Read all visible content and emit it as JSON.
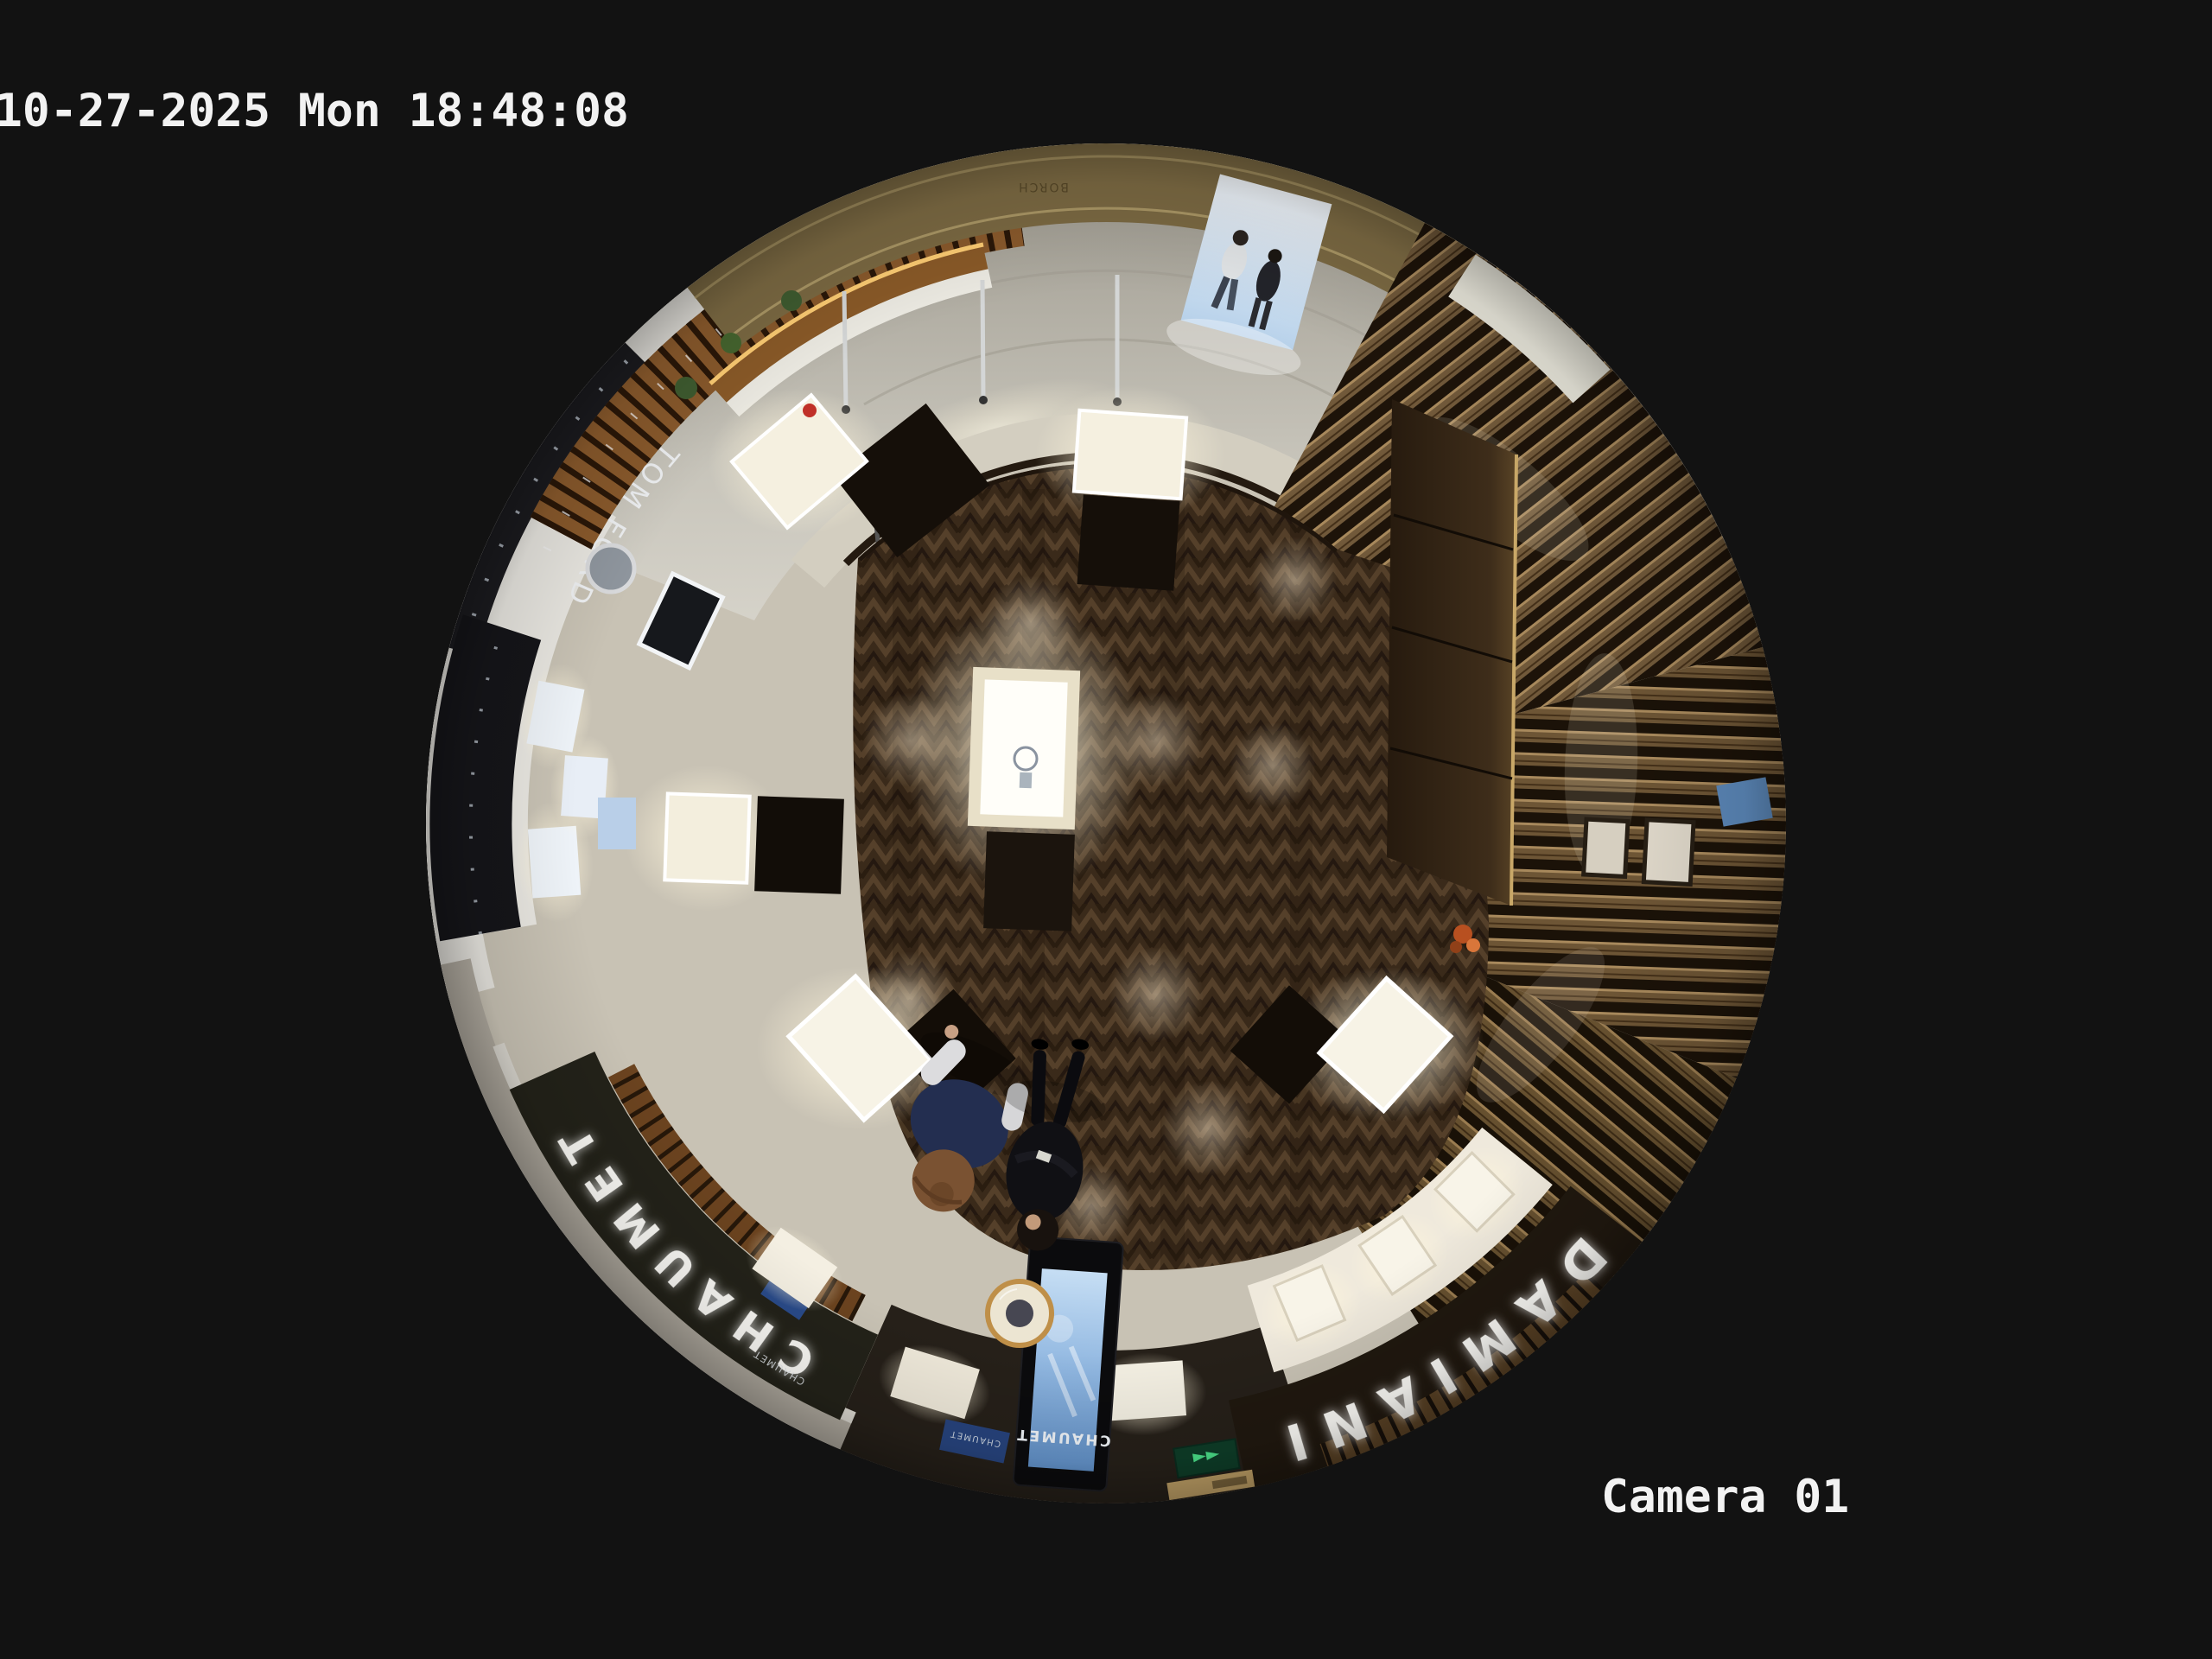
{
  "osd": {
    "timestamp": "10-27-2025 Mon 18:48:08",
    "camera_label": "Camera 01"
  },
  "signs": {
    "chaumet_fascia": "CHAUMET",
    "damiani_fascia": "DAMIANI",
    "tom_ford": "TOM FORD",
    "kiosk_screen_brand": "CHAUMET",
    "chaumet_plaque": "CHAUMET",
    "boutique_small_sign": "CHAUMET",
    "mall_wall_text": "BORCH",
    "exit_arrows": "◄◄"
  },
  "colors": {
    "background": "#121212",
    "osd_text": "#f2f2f2",
    "sign_letters": "#fbfaf6",
    "exit_green": "#4ade88",
    "gold_wall": "#7c6a43",
    "led_strip": "#ffce74",
    "wood_floor_base": "#3a2a1a",
    "marble_light": "#dbd8cf",
    "white_wall": "#e7e5df",
    "fascia_dark": "#232219",
    "damiani_fascia_brown": "#20180f",
    "slat_brown": "#6d5535",
    "tile_beige": "#c8c2b4",
    "kiosk_screen_top": "#c6def4",
    "kiosk_screen_bottom": "#6090c8"
  }
}
